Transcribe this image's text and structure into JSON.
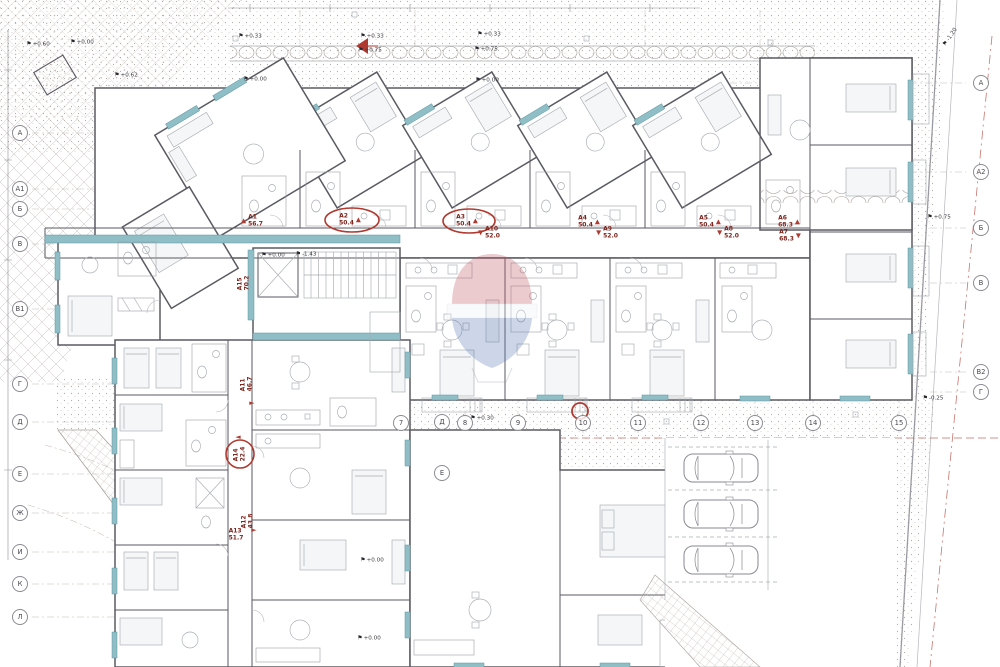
{
  "drawing": {
    "units": [
      {
        "id": "A1",
        "area": "56.7"
      },
      {
        "id": "A2",
        "area": "50.4"
      },
      {
        "id": "A3",
        "area": "50.4"
      },
      {
        "id": "A4",
        "area": "50.4"
      },
      {
        "id": "A5",
        "area": "50.4"
      },
      {
        "id": "A6",
        "area": "68.3"
      },
      {
        "id": "A7",
        "area": "68.3"
      },
      {
        "id": "A8",
        "area": "52.0"
      },
      {
        "id": "A9",
        "area": "52.0"
      },
      {
        "id": "A10",
        "area": "52.0"
      },
      {
        "id": "A11",
        "area": "46.7"
      },
      {
        "id": "A12",
        "area": "43.8"
      },
      {
        "id": "A13",
        "area": "51.7"
      },
      {
        "id": "A14",
        "area": "22.4"
      },
      {
        "id": "A15",
        "area": "70.2"
      }
    ],
    "grid_axes": {
      "left": [
        "А",
        "А1",
        "Б",
        "В",
        "В1",
        "Г",
        "Д",
        "Е",
        "Ж",
        "И",
        "К",
        "Л"
      ],
      "bottom": [
        "7",
        "8",
        "9",
        "10",
        "11",
        "12",
        "13",
        "14",
        "15"
      ],
      "bottom_letters": [
        "Д",
        "Е"
      ],
      "right": [
        "А",
        "А2",
        "Б",
        "В",
        "В2",
        "Г"
      ]
    },
    "elevations": [
      "+0.60",
      "+0.00",
      "+0.33",
      "+0.62",
      "+0.00",
      "+0.33",
      "+0.75",
      "+0.33",
      "+0.75",
      "+0.00",
      "+0.00",
      "-1.43",
      "+0.30",
      "+0.00",
      "+0.00",
      "+0.75",
      "-0.25",
      "-1.20"
    ],
    "icons": {
      "flag": "⚑",
      "arrow_up": "▲",
      "arrow_down": "▼",
      "arrow_right": "►",
      "arrow_left": "◄"
    },
    "annotations": {
      "highlighted_units": [
        "A2",
        "A3",
        "A14"
      ],
      "highlight_color": "#b03a30"
    },
    "watermark": {
      "name": "remax-balloon"
    },
    "parking": {
      "cars": 3
    },
    "colors": {
      "wall": "#5a5a62",
      "glazing": "#8fbec6",
      "annotation": "#b03a30",
      "label": "#7d241c"
    }
  }
}
